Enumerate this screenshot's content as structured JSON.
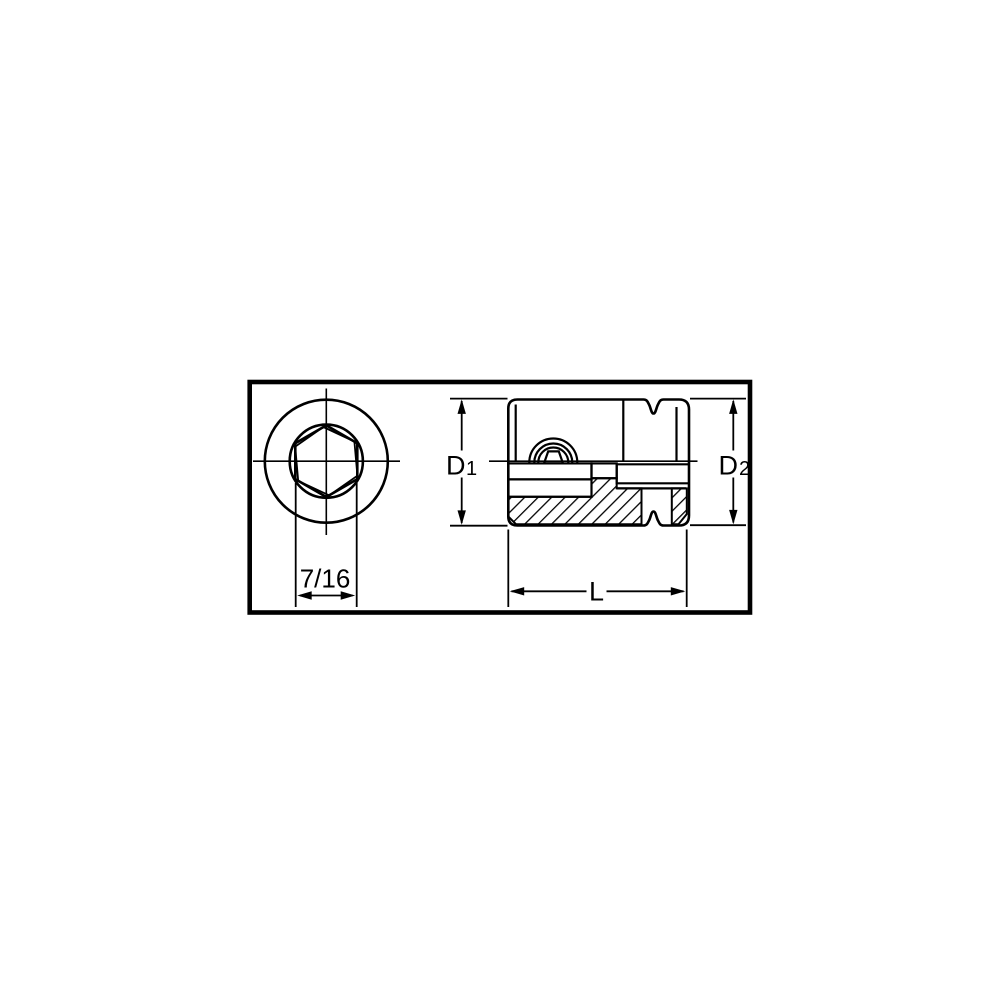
{
  "page": {
    "background": "#ffffff"
  },
  "drawing": {
    "line_color": "#000000",
    "border_color": "#000000",
    "labels": {
      "hex_size": "7/16",
      "d1": {
        "main": "D",
        "sub": "1"
      },
      "d2": {
        "main": "D",
        "sub": "2"
      },
      "length": "L"
    }
  }
}
